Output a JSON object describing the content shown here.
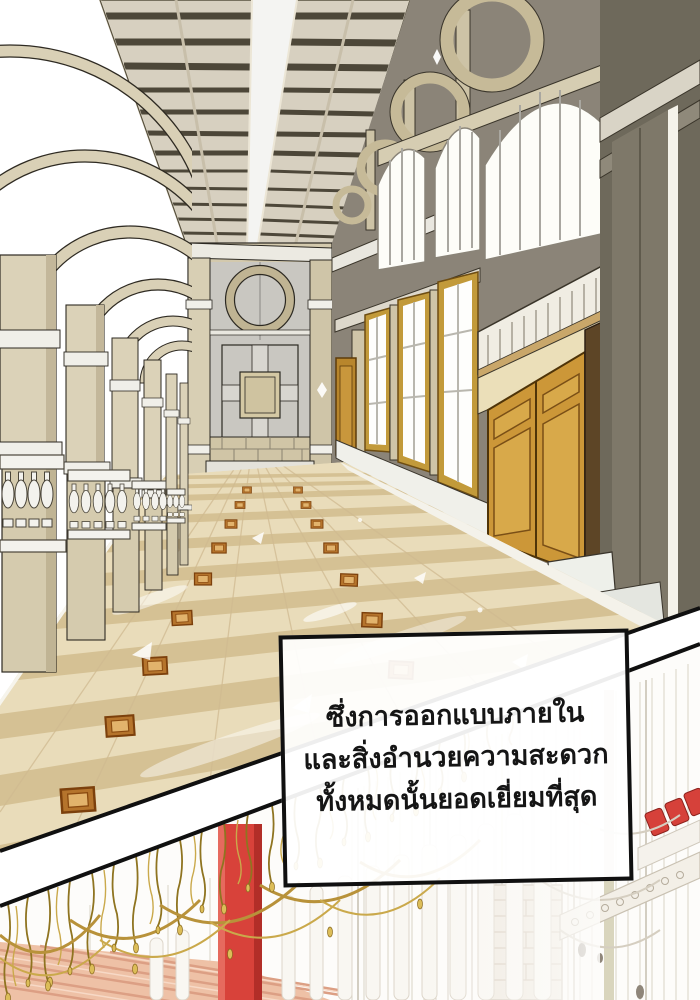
{
  "narration": {
    "lines": [
      "ซึ่งการออกแบบภายใน",
      "และสิ่งอำนวยความสะดวก",
      "ทั้งหมดนั้นยอดเยี่ยมที่สุด"
    ]
  },
  "palette": {
    "panel_border": "#101010",
    "dialogue_background": "#ffffff",
    "dialogue_text": "#151515",
    "hall_stone_beige": "#d9d0b6",
    "hall_floor_beige": "#e9dcba",
    "floor_band_tan": "#d5c194",
    "floor_medallion_brown": "#b5742c",
    "door_gold": "#cc9738",
    "wall_olive": "#7e7869",
    "window_light": "#fdfdf8",
    "chandelier_gold": "#b8923a",
    "pillar_red": "#d8423a",
    "wood_floor_pink": "#eec1a6",
    "sketch_line_grey": "#d9d3c7"
  }
}
